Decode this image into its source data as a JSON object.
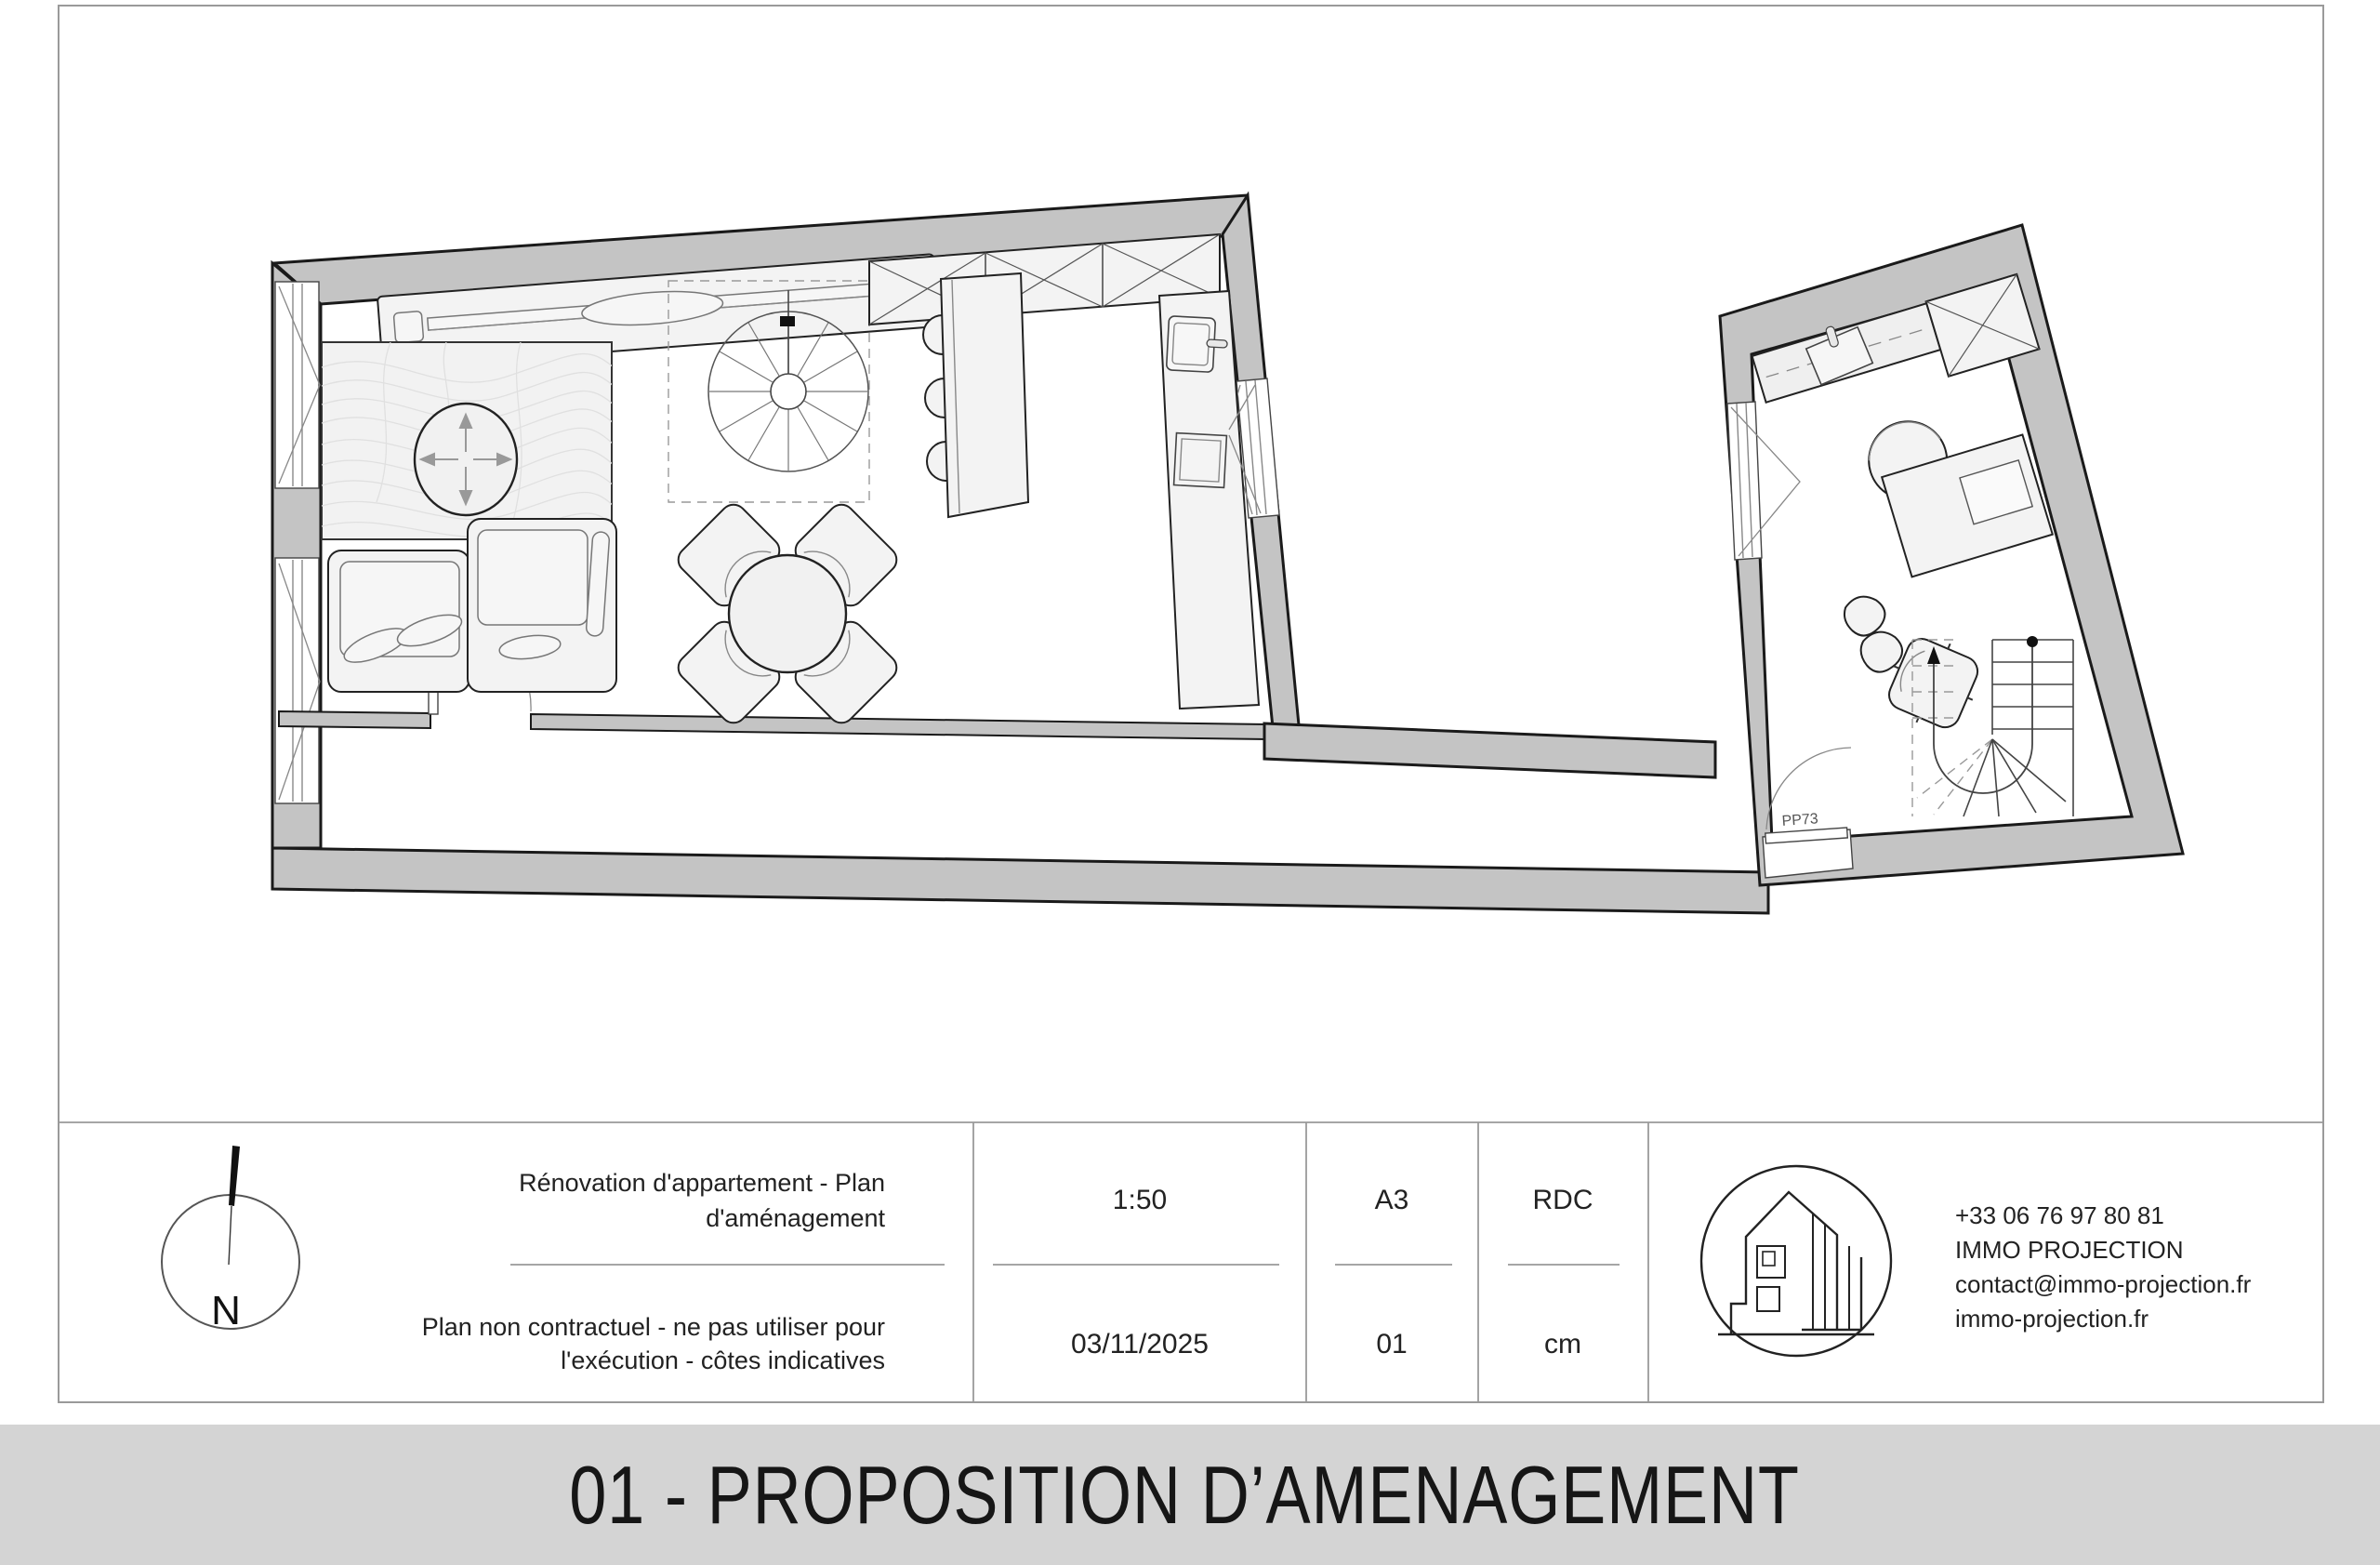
{
  "plan": {
    "door_label": "PP73",
    "north_label": "N"
  },
  "title_block": {
    "project_title_line1": "Rénovation d'appartement - Plan",
    "project_title_line2": "d'aménagement",
    "disclaimer_line1": "Plan non contractuel - ne pas utiliser pour",
    "disclaimer_line2": "l'exécution - côtes indicatives",
    "scale": "1:50",
    "date": "03/11/2025",
    "paper_size": "A3",
    "sheet_number": "01",
    "level": "RDC",
    "units": "cm",
    "company": {
      "phone": "+33 06 76 97 80 81",
      "name": "IMMO PROJECTION",
      "email": "contact@immo-projection.fr",
      "website": "immo-projection.fr"
    }
  },
  "banner": {
    "text": "01 - PROPOSITION D’AMENAGEMENT"
  },
  "colors": {
    "wall": "#c4c4c4",
    "banner": "#d4d4d4",
    "line": "#1a1a1a",
    "furniture": "#f3f3f3"
  }
}
